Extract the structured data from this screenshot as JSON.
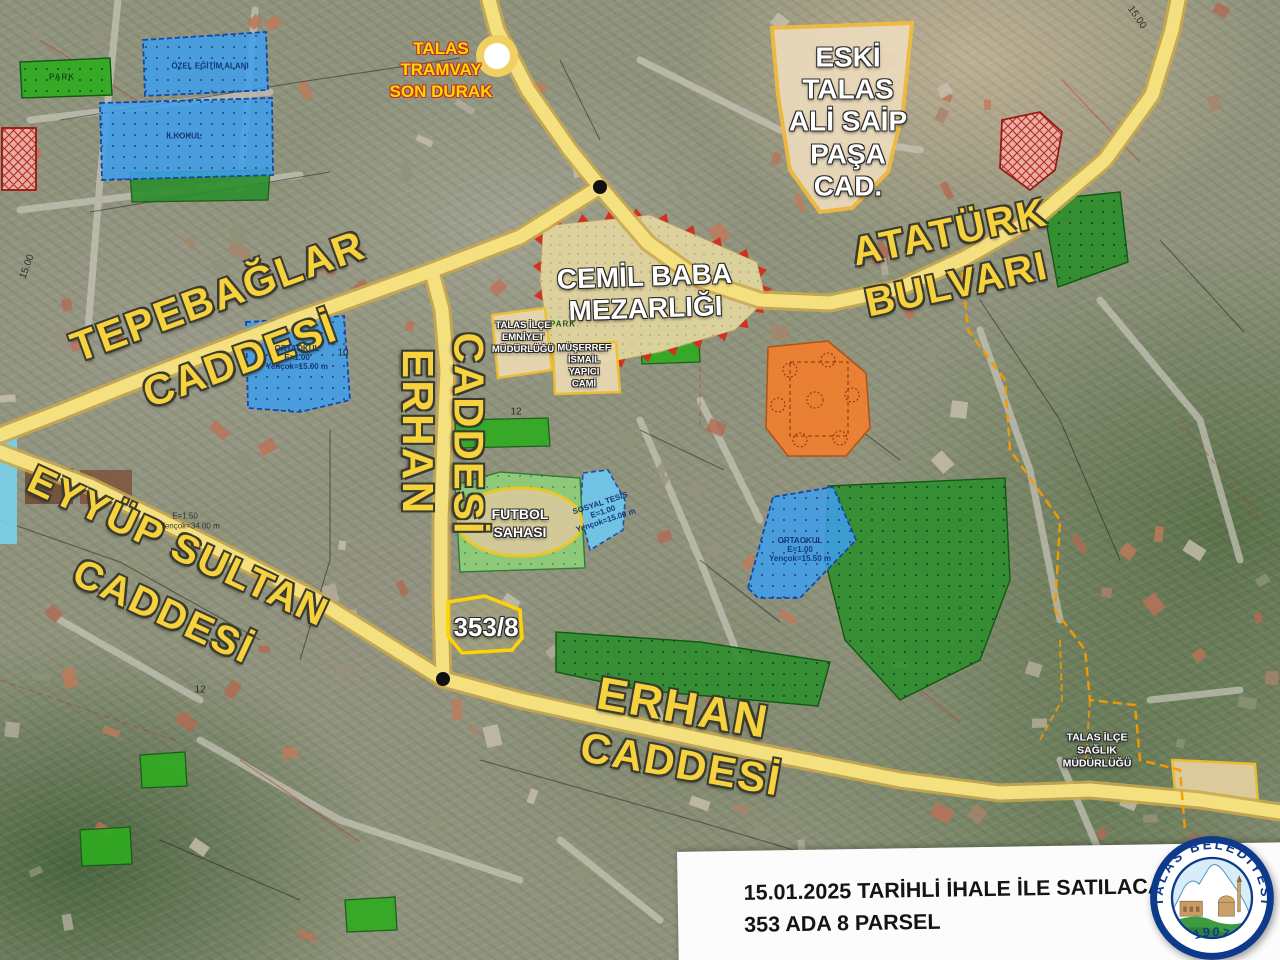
{
  "map": {
    "tram_stop": {
      "lines": [
        "TALAS",
        "TRAMVAY",
        "SON DURAK"
      ]
    },
    "streets": {
      "tepebaglar": {
        "line1": "TEPEBAĞLAR",
        "line2": "CADDESİ"
      },
      "erhan_vertical": {
        "line1": "ERHAN",
        "line2": "CADDESİ"
      },
      "ataturk": {
        "line1": "ATATÜRK",
        "line2": "BULVARI"
      },
      "eyyup_sultan": {
        "line1": "EYYÜP SULTAN",
        "line2": "CADDESİ"
      },
      "erhan_lower": {
        "line1": "ERHAN",
        "line2": "CADDESİ"
      }
    },
    "areas": {
      "eski_talas": {
        "lines": [
          "ESKİ",
          "TALAS",
          "ALİ SAİP",
          "PAŞA",
          "CAD."
        ]
      },
      "cemil_baba": {
        "line1": "CEMİL BABA",
        "line2": "MEZARLIĞI"
      },
      "emniyet": {
        "lines": [
          "TALAS İLÇE",
          "EMNİYET",
          "MÜDÜRLÜĞÜ"
        ]
      },
      "cami": {
        "lines": [
          "MÜŞERREF",
          "İSMAİL",
          "YAPICI",
          "CAMİ"
        ]
      },
      "futbol": {
        "line1": "FUTBOL",
        "line2": "SAHASI"
      },
      "saglik": {
        "lines": [
          "TALAS İLÇE",
          "SAĞLIK",
          "MÜDÜRLÜĞÜ"
        ]
      }
    },
    "parcel_label": "353/8",
    "zoning_labels": {
      "ozel_egitim": "ÖZEL EĞİTİM ALANI",
      "ilkokul": "İLKOKUL",
      "park": "PARK",
      "ortaokul_left": {
        "lines": [
          "ORTAOKUL",
          "E=1.00",
          "Yençok=15.00 m"
        ]
      },
      "ortaokul_right": {
        "lines": [
          "ORTAOKUL",
          "E=1.00",
          "Yençok=15.50 m"
        ]
      },
      "sosyal_tesis": {
        "lines": [
          "SOSYAL TESİS",
          "E=1.00",
          "Yençok=15.00 m"
        ]
      },
      "e_note": "E=1.50",
      "y_note": "Yençok=34.00 m",
      "w15": "15.00",
      "w10": "10",
      "w12": "12"
    }
  },
  "info_box": {
    "line1": "15.01.2025 TARİHLİ İHALE İLE SATILACAK PARSEL",
    "line2": "353 ADA 8 PARSEL"
  },
  "logo": {
    "ring_text": "TALAS BELEDİYESİ",
    "year": "1907"
  }
}
